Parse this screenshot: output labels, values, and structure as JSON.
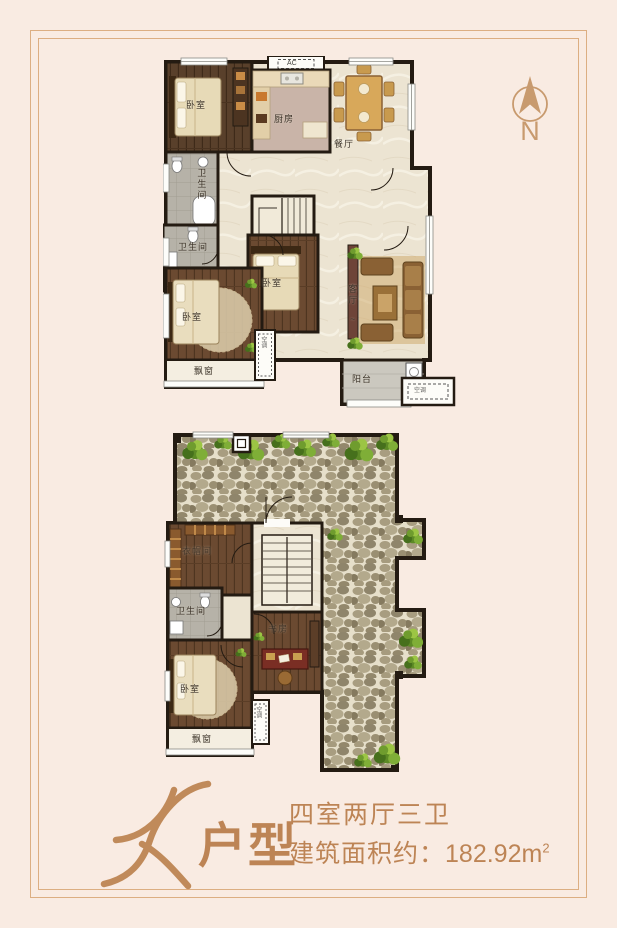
{
  "compass": {
    "north": "N"
  },
  "labels": {
    "bedroom": "卧室",
    "kitchen": "厨房",
    "dining": "餐厅",
    "bathroom": "卫生间",
    "living": "客厅",
    "living_mark": "~",
    "balcony": "阳台",
    "bay_window": "飘窗",
    "study": "书房",
    "closet": "衣帽间",
    "ac_en": "AC",
    "ac_cn": "空调"
  },
  "footer": {
    "letter": "K",
    "suffix": "户型",
    "spec": "四室两厅三卫",
    "area_prefix": "建筑面积约：",
    "area_value": "182.92m",
    "area_sup": "2"
  },
  "colors": {
    "accent": "#bd8455",
    "frame": "#dcae82",
    "wall": "#241b12",
    "page_bg": "#f9ebe2"
  }
}
